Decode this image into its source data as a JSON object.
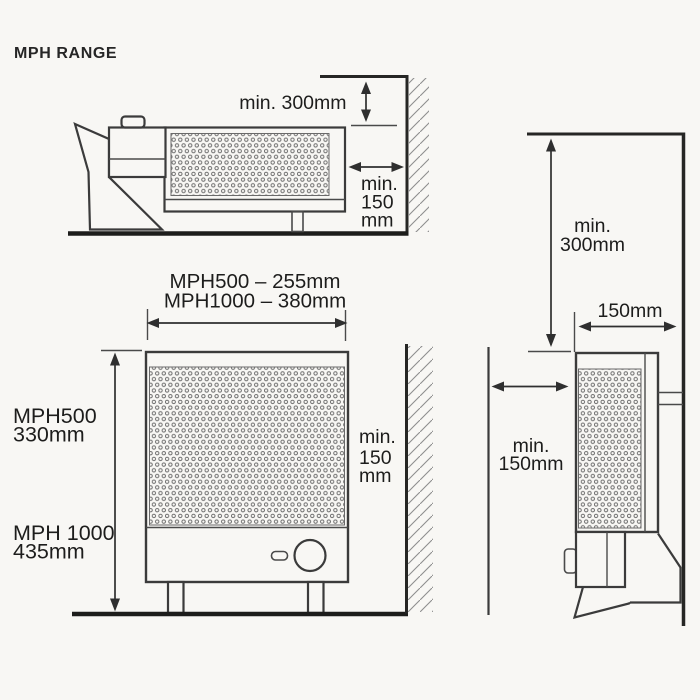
{
  "title": "MPH RANGE",
  "colors": {
    "ink": "#3b3b3b",
    "heavy_line": "#1d1d1b",
    "background": "#f8f7f4"
  },
  "plan_view": {
    "clearance_above": "min. 300mm",
    "clearance_side_line1": "min.",
    "clearance_side_line2": "150",
    "clearance_side_line3": "mm"
  },
  "front_view": {
    "width_mph500": "MPH500 – 255mm",
    "width_mph1000": "MPH1000 – 380mm",
    "height_mph500_name": "MPH500",
    "height_mph500_value": "330mm",
    "height_mph1000_name": "MPH 1000",
    "height_mph1000_value": "435mm",
    "clearance_side_line1": "min.",
    "clearance_side_line2": "150",
    "clearance_side_line3": "mm"
  },
  "side_view": {
    "clearance_above_line1": "min.",
    "clearance_above_line2": "300mm",
    "depth": "150mm",
    "clearance_front_line1": "min.",
    "clearance_front_line2": "150mm"
  }
}
